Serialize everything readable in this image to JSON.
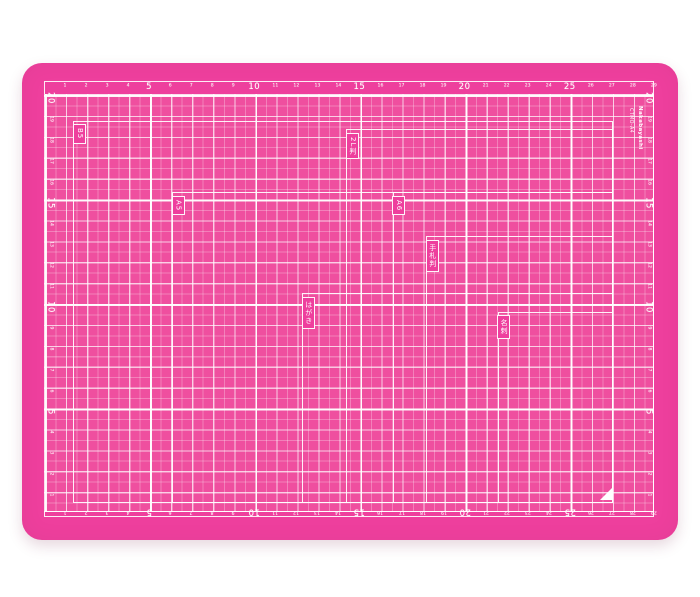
{
  "product": {
    "model": "CTMO-A4",
    "brand": "Nakabayashi"
  },
  "mat": {
    "type_label": "cutting-mat",
    "colors": {
      "mat_pink": "#ee3f9d",
      "grid_pink": "#ef4f9f",
      "line_5mm": "rgba(255,255,255,0.28)",
      "line_1cm": "rgba(255,255,255,0.62)",
      "line_5cm": "rgba(255,255,255,0.95)",
      "print_white": "#ffffff"
    }
  },
  "rulers": {
    "unit": "cm",
    "horizontal": {
      "major": [
        5,
        10,
        15,
        20,
        25
      ],
      "minor": [
        1,
        2,
        3,
        4,
        6,
        7,
        8,
        9,
        11,
        12,
        13,
        14,
        16,
        17,
        18,
        19,
        21,
        22,
        23,
        24,
        26,
        27,
        28,
        29
      ]
    },
    "vertical": {
      "major": [
        5,
        10,
        15,
        20
      ],
      "minor": [
        1,
        2,
        3,
        4,
        6,
        7,
        8,
        9,
        11,
        12,
        13,
        14,
        16,
        17,
        18,
        19
      ]
    }
  },
  "paper_guides": [
    {
      "label": "B5",
      "width_mm": 257,
      "height_mm": 182
    },
    {
      "label": "2L判",
      "width_mm": 127,
      "height_mm": 178
    },
    {
      "label": "A5",
      "width_mm": 210,
      "height_mm": 148
    },
    {
      "label": "A6",
      "width_mm": 105,
      "height_mm": 148
    },
    {
      "label": "手札判",
      "width_mm": 89,
      "height_mm": 127
    },
    {
      "label": "はがき",
      "width_mm": 148,
      "height_mm": 100
    },
    {
      "label": "名刺",
      "width_mm": 55,
      "height_mm": 91
    }
  ],
  "corner_mark": "triangle"
}
